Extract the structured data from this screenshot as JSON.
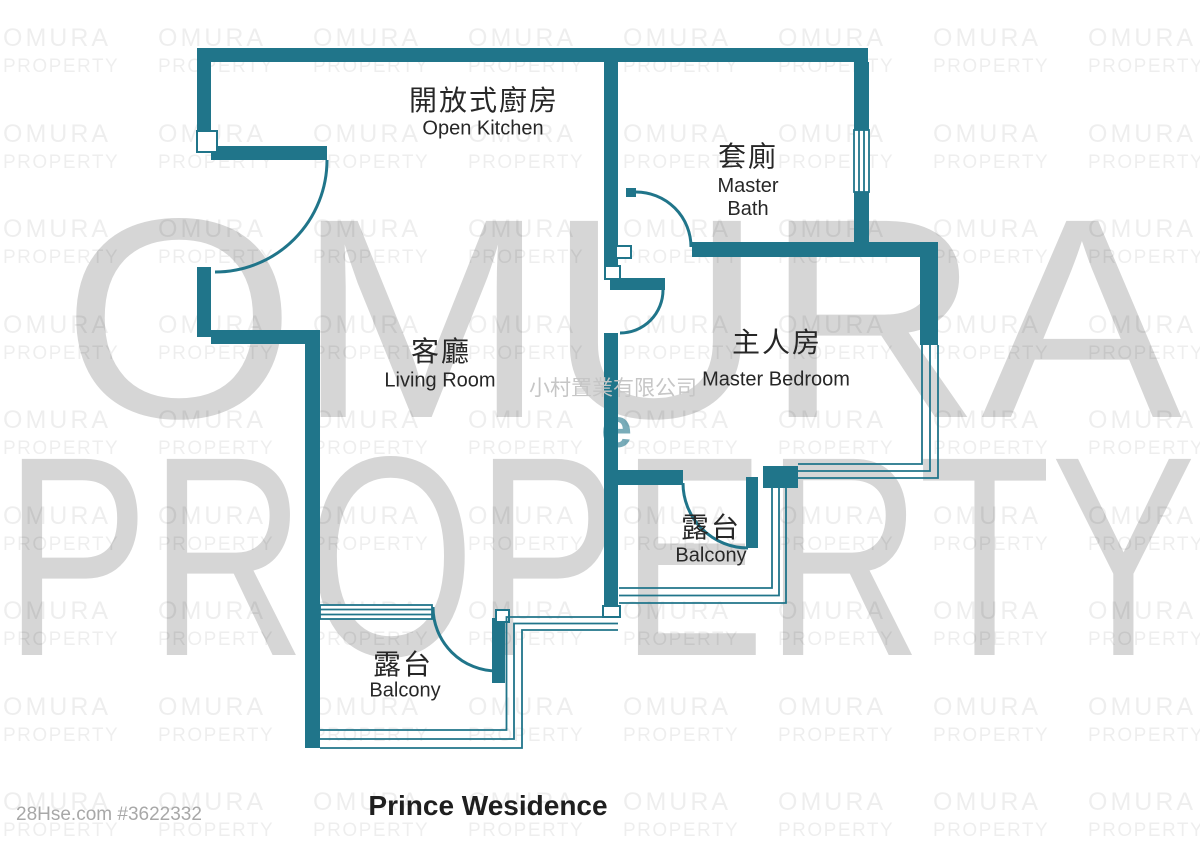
{
  "page": {
    "width": 1200,
    "height": 848,
    "background": "#ffffff"
  },
  "palette": {
    "wall": "#20758a",
    "bigwm": "rgba(0,0,0,0.16)",
    "tilewm": "rgba(0,0,0,0.065)",
    "agency": "#c6c6c6",
    "footer": "#a8a8a8",
    "label": "#272727",
    "tealletter": "rgba(32,117,138,0.6)"
  },
  "watermarks": {
    "tile_line1": "OMURA",
    "tile_line2": "PROPERTY",
    "giant_line1": "OMURA",
    "giant_line2": "PROPERTY",
    "agency_name_cjk": "小村置業有限公司",
    "teal_letter": "e"
  },
  "rooms": {
    "kitchen": {
      "name_cjk": "開放式廚房",
      "name_en": "Open Kitchen"
    },
    "master_bath": {
      "name_cjk": "套廁",
      "name_en": "Master Bath"
    },
    "living_room": {
      "name_cjk": "客廳",
      "name_en": "Living Room"
    },
    "master_bedroom": {
      "name_cjk": "主人房",
      "name_en": "Master Bedroom"
    },
    "balcony_bedroom": {
      "name_cjk": "露台",
      "name_en": "Balcony"
    },
    "balcony_living": {
      "name_cjk": "露台",
      "name_en": "Balcony"
    }
  },
  "footer": {
    "listing_ref": "28Hse.com #3622332",
    "building_title": "Prince Wesidence"
  }
}
